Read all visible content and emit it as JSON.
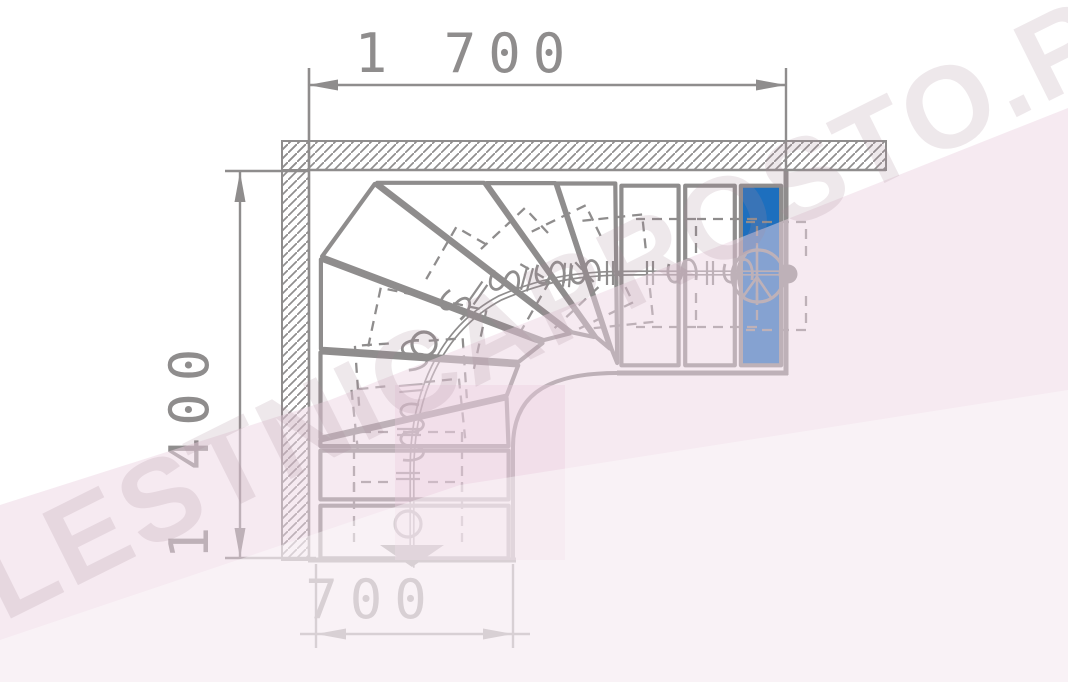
{
  "title": "L-shaped winder staircase plan drawing (90-degree turn)",
  "colors": {
    "line_gray": "#8f8d8d",
    "blue_step": "#1d6fbe",
    "background": "#ffffff",
    "pink_overlay": "#eed5e3",
    "pink_deep": "#eccbdd",
    "watermark_letters": "#a88d9c"
  },
  "dimensions": {
    "top": {
      "label": "1 700"
    },
    "left": {
      "label": "1 400"
    },
    "bottom": {
      "label": "700"
    }
  },
  "watermark": {
    "text": "LESTNICAPROSTO.RU"
  },
  "icons": [
    "start-direction-arrow-icon",
    "module-circle-icon",
    "support-post-circle-icon",
    "end-dot-icon",
    "dimension-arrowhead-icon",
    "wall-hatch-pattern"
  ],
  "stair": {
    "tread_count": 12,
    "treads": [
      {
        "id": "tread-1",
        "fill": "white",
        "points": [
          [
            316,
            504
          ],
          [
            513,
            504
          ],
          [
            513,
            560
          ],
          [
            316,
            560
          ]
        ]
      },
      {
        "id": "tread-2",
        "fill": "white",
        "points": [
          [
            316,
            449
          ],
          [
            513,
            449
          ],
          [
            513,
            501
          ],
          [
            316,
            501
          ]
        ]
      },
      {
        "id": "tread-3",
        "fill": "white",
        "points": [
          [
            316,
            447
          ],
          [
            513,
            447
          ],
          [
            511,
            396
          ],
          [
            316,
            441
          ]
        ]
      },
      {
        "id": "tread-4",
        "fill": "white",
        "points": [
          [
            316,
            441
          ],
          [
            511,
            396
          ],
          [
            523,
            364
          ],
          [
            316,
            350
          ]
        ]
      },
      {
        "id": "tread-5",
        "fill": "white",
        "points": [
          [
            316,
            350
          ],
          [
            523,
            364
          ],
          [
            548,
            344
          ],
          [
            316,
            255
          ]
        ]
      },
      {
        "id": "tread-6",
        "fill": "white",
        "points": [
          [
            316,
            255
          ],
          [
            548,
            344
          ],
          [
            575,
            337
          ],
          [
            371,
            178
          ]
        ]
      },
      {
        "id": "tread-7",
        "fill": "white",
        "points": [
          [
            371,
            178
          ],
          [
            575,
            337
          ],
          [
            598,
            342
          ],
          [
            483,
            178
          ]
        ]
      },
      {
        "id": "tread-8",
        "fill": "white",
        "points": [
          [
            483,
            178
          ],
          [
            598,
            342
          ],
          [
            612,
            354
          ],
          [
            555,
            178
          ]
        ]
      },
      {
        "id": "tread-9",
        "fill": "white",
        "points": [
          [
            555,
            178
          ],
          [
            612,
            354
          ],
          [
            618,
            369
          ],
          [
            616,
            178
          ]
        ]
      },
      {
        "id": "tread-10",
        "fill": "white",
        "points": [
          [
            620,
            180
          ],
          [
            680,
            180
          ],
          [
            680,
            371
          ],
          [
            620,
            371
          ]
        ]
      },
      {
        "id": "tread-11",
        "fill": "white",
        "points": [
          [
            684,
            180
          ],
          [
            736,
            180
          ],
          [
            736,
            371
          ],
          [
            684,
            371
          ]
        ]
      },
      {
        "id": "tread-12-top",
        "fill": "blue",
        "points": [
          [
            740,
            180
          ],
          [
            782,
            180
          ],
          [
            782,
            371
          ],
          [
            740,
            371
          ]
        ]
      }
    ],
    "walk_path": "M412,566 L412,470 C412,395 440,330 500,298 C560,272 600,273 660,273 L788,273",
    "brackets": [
      [
        408,
        528,
        0
      ],
      [
        408,
        478,
        0
      ],
      [
        410,
        430,
        -6
      ],
      [
        412,
        388,
        -4
      ],
      [
        424,
        344,
        12
      ],
      [
        480,
        294,
        30
      ],
      [
        528,
        279,
        47
      ],
      [
        568,
        274,
        64
      ],
      [
        602,
        273,
        84
      ],
      [
        650,
        273,
        90
      ],
      [
        711,
        273,
        90
      ],
      [
        760,
        276,
        90
      ]
    ],
    "hooks": [
      [
        410,
        447,
        0
      ],
      [
        410,
        419,
        0
      ],
      [
        413,
        356,
        -12
      ],
      [
        455,
        306,
        -50
      ],
      [
        505,
        283,
        -72
      ],
      [
        551,
        275,
        -85
      ],
      [
        586,
        274,
        -90
      ],
      [
        683,
        273,
        -90
      ],
      [
        739,
        273,
        -90
      ]
    ],
    "ticks": [
      [
        408,
        476,
        0
      ],
      [
        409,
        432,
        0
      ],
      [
        411,
        388,
        -5
      ],
      [
        478,
        293,
        -55
      ],
      [
        527,
        279,
        -75
      ],
      [
        567,
        275,
        -85
      ],
      [
        610,
        273,
        -90
      ],
      [
        650,
        273,
        -90
      ],
      [
        710,
        273,
        -90
      ]
    ],
    "modules": [
      {
        "x": 408,
        "y": 524,
        "r": 13
      },
      {
        "x": 424,
        "y": 344,
        "r": 12
      }
    ],
    "start_arrow": [
      [
        380,
        545
      ],
      [
        444,
        545
      ],
      [
        412,
        567
      ]
    ],
    "end_dot": {
      "x": 788,
      "y": 274,
      "r": 9.5
    },
    "post_symbol": {
      "x": 758,
      "y": 276,
      "r": 26
    }
  }
}
